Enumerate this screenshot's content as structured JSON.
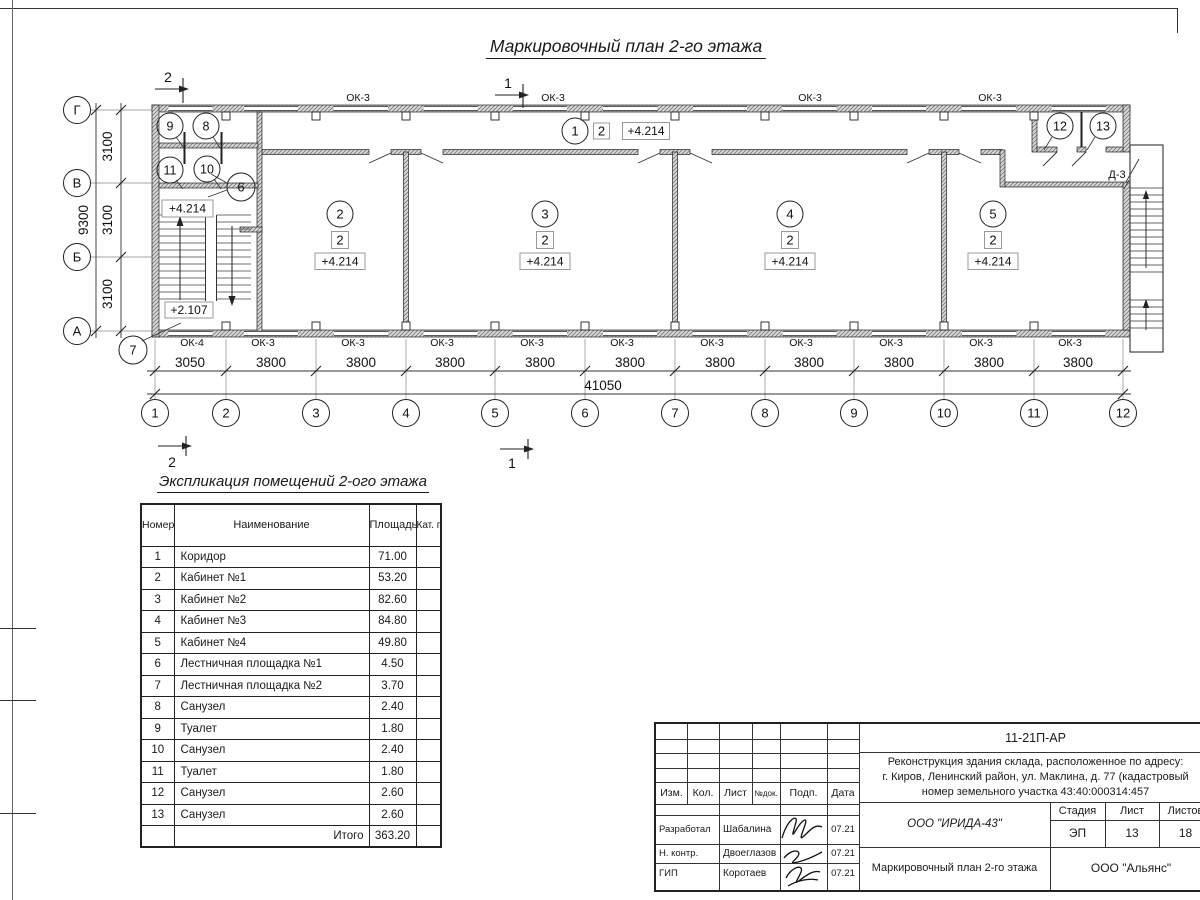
{
  "sheet": {
    "plan_title": "Маркировочный план 2-го этажа",
    "table_title": "Экспликация помещений 2-ого этажа"
  },
  "plan": {
    "marks": {
      "top_left": "2",
      "top_center": "1",
      "bottom_left": "2",
      "bottom_center": "1"
    },
    "axes_h": [
      "1",
      "2",
      "3",
      "4",
      "5",
      "6",
      "7",
      "8",
      "9",
      "10",
      "11",
      "12"
    ],
    "axes_v": [
      "Г",
      "В",
      "Б",
      "А"
    ],
    "dims_h": [
      "3050",
      "3800",
      "3800",
      "3800",
      "3800",
      "3800",
      "3800",
      "3800",
      "3800",
      "3800",
      "3800"
    ],
    "dims_h_total": "41050",
    "dims_v": [
      "3100",
      "3100",
      "3100"
    ],
    "dims_v_total": "9300",
    "win_top": [
      "ОК-3",
      "ОК-3",
      "ОК-3",
      "ОК-3"
    ],
    "win_bottom": [
      "ОК-4",
      "ОК-3",
      "ОК-3",
      "ОК-3",
      "ОК-3",
      "ОК-3",
      "ОК-3",
      "ОК-3",
      "ОК-3",
      "ОК-3",
      "ОК-3"
    ],
    "door_label": "Д-3",
    "room1": {
      "num": "1",
      "cat": "2",
      "elev": "+4.214"
    },
    "rooms_main": [
      {
        "num": "2",
        "cat": "2",
        "elev": "+4.214"
      },
      {
        "num": "3",
        "cat": "2",
        "elev": "+4.214"
      },
      {
        "num": "4",
        "cat": "2",
        "elev": "+4.214"
      },
      {
        "num": "5",
        "cat": "2",
        "elev": "+4.214"
      }
    ],
    "small_rooms": {
      "r6": "6",
      "r7": "7",
      "r8": "8",
      "r9": "9",
      "r10": "10",
      "r11": "11",
      "r12": "12",
      "r13": "13"
    },
    "elev_landing": "+4.214",
    "elev_stair": "+2.107"
  },
  "table": {
    "headers": {
      "num": "Номер помещ.",
      "name": "Наименование",
      "area": "Площадь",
      "cat": "Кат. пом."
    },
    "rows": [
      {
        "n": "1",
        "name": "Коридор",
        "area": "71.00"
      },
      {
        "n": "2",
        "name": "Кабинет №1",
        "area": "53.20"
      },
      {
        "n": "3",
        "name": "Кабинет №2",
        "area": "82.60"
      },
      {
        "n": "4",
        "name": "Кабинет №3",
        "area": "84.80"
      },
      {
        "n": "5",
        "name": "Кабинет №4",
        "area": "49.80"
      },
      {
        "n": "6",
        "name": "Лестничная площадка №1",
        "area": "4.50"
      },
      {
        "n": "7",
        "name": "Лестничная площадка №2",
        "area": "3.70"
      },
      {
        "n": "8",
        "name": "Санузел",
        "area": "2.40"
      },
      {
        "n": "9",
        "name": "Туалет",
        "area": "1.80"
      },
      {
        "n": "10",
        "name": "Санузел",
        "area": "2.40"
      },
      {
        "n": "11",
        "name": "Туалет",
        "area": "1.80"
      },
      {
        "n": "12",
        "name": "Санузел",
        "area": "2.60"
      },
      {
        "n": "13",
        "name": "Санузел",
        "area": "2.60"
      }
    ],
    "total_label": "Итого",
    "total": "363.20"
  },
  "titleblock": {
    "doc_code": "11-21П-АР",
    "project_line1": "Реконструкция здания склада, расположенное по адресу:",
    "project_line2": "г. Киров, Ленинский район, ул. Маклина, д. 77 (кадастровый",
    "project_line3": "номер земельного участка 43:40:000314:457",
    "cols": {
      "izm": "Изм.",
      "kol": "Кол.",
      "list": "Лист",
      "ndok": "№док.",
      "podp": "Подп.",
      "data": "Дата"
    },
    "roles": [
      {
        "role": "Разработал",
        "name": "Шабалина",
        "date": "07.21"
      },
      {
        "role": "Н. контр.",
        "name": "Двоеглазов",
        "date": "07.21"
      },
      {
        "role": "ГИП",
        "name": "Коротаев",
        "date": "07.21"
      }
    ],
    "org": "ООО \"ИРИДА-43\"",
    "sheet_name": "Маркировочный план 2-го этажа",
    "stage_label": "Стадия",
    "sheet_label": "Лист",
    "sheets_label": "Листов",
    "stage": "ЭП",
    "sheet_no": "13",
    "sheets_total": "18",
    "firm": "ООО \"Альянс\""
  }
}
